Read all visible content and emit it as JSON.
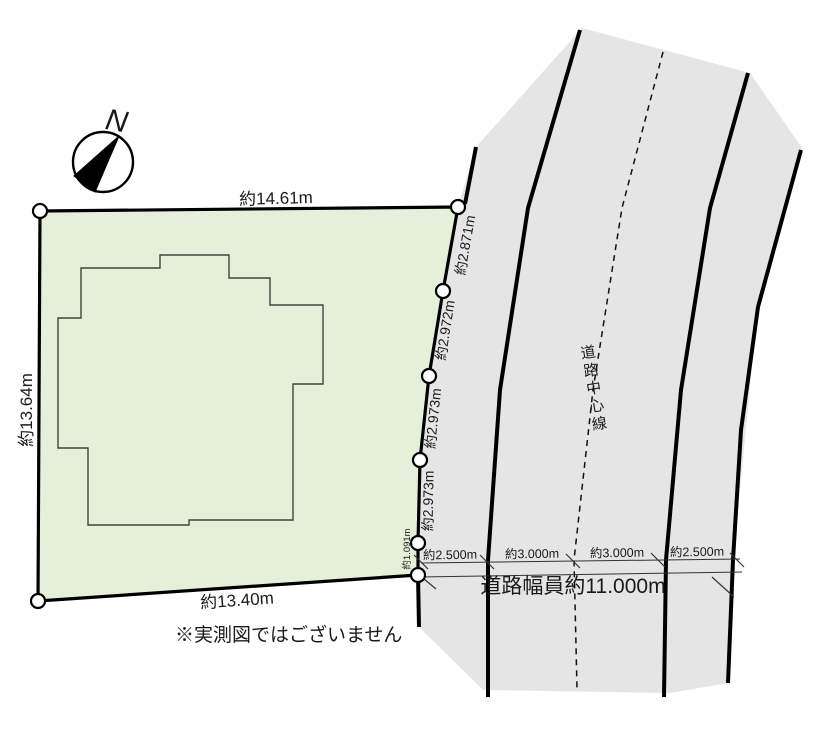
{
  "colors": {
    "plot_fill": "#e5efda",
    "road_fill": "#e5e5e5",
    "line": "#000000"
  },
  "compass": {
    "label": "N"
  },
  "plot": {
    "top_label": "約14.61m",
    "left_label": "約13.64m",
    "bottom_label": "約13.40m",
    "right_edge_labels": [
      "約2.871m",
      "約2.972m",
      "約2.973m",
      "約2.973m",
      "約1.091m"
    ]
  },
  "road": {
    "center_line_label": "道路中心線",
    "width_segments": [
      "約2.500m",
      "約3.000m",
      "約3.000m",
      "約2.500m"
    ],
    "total_width_label": "道路幅員約11.000m"
  },
  "note": "※実測図ではございません"
}
